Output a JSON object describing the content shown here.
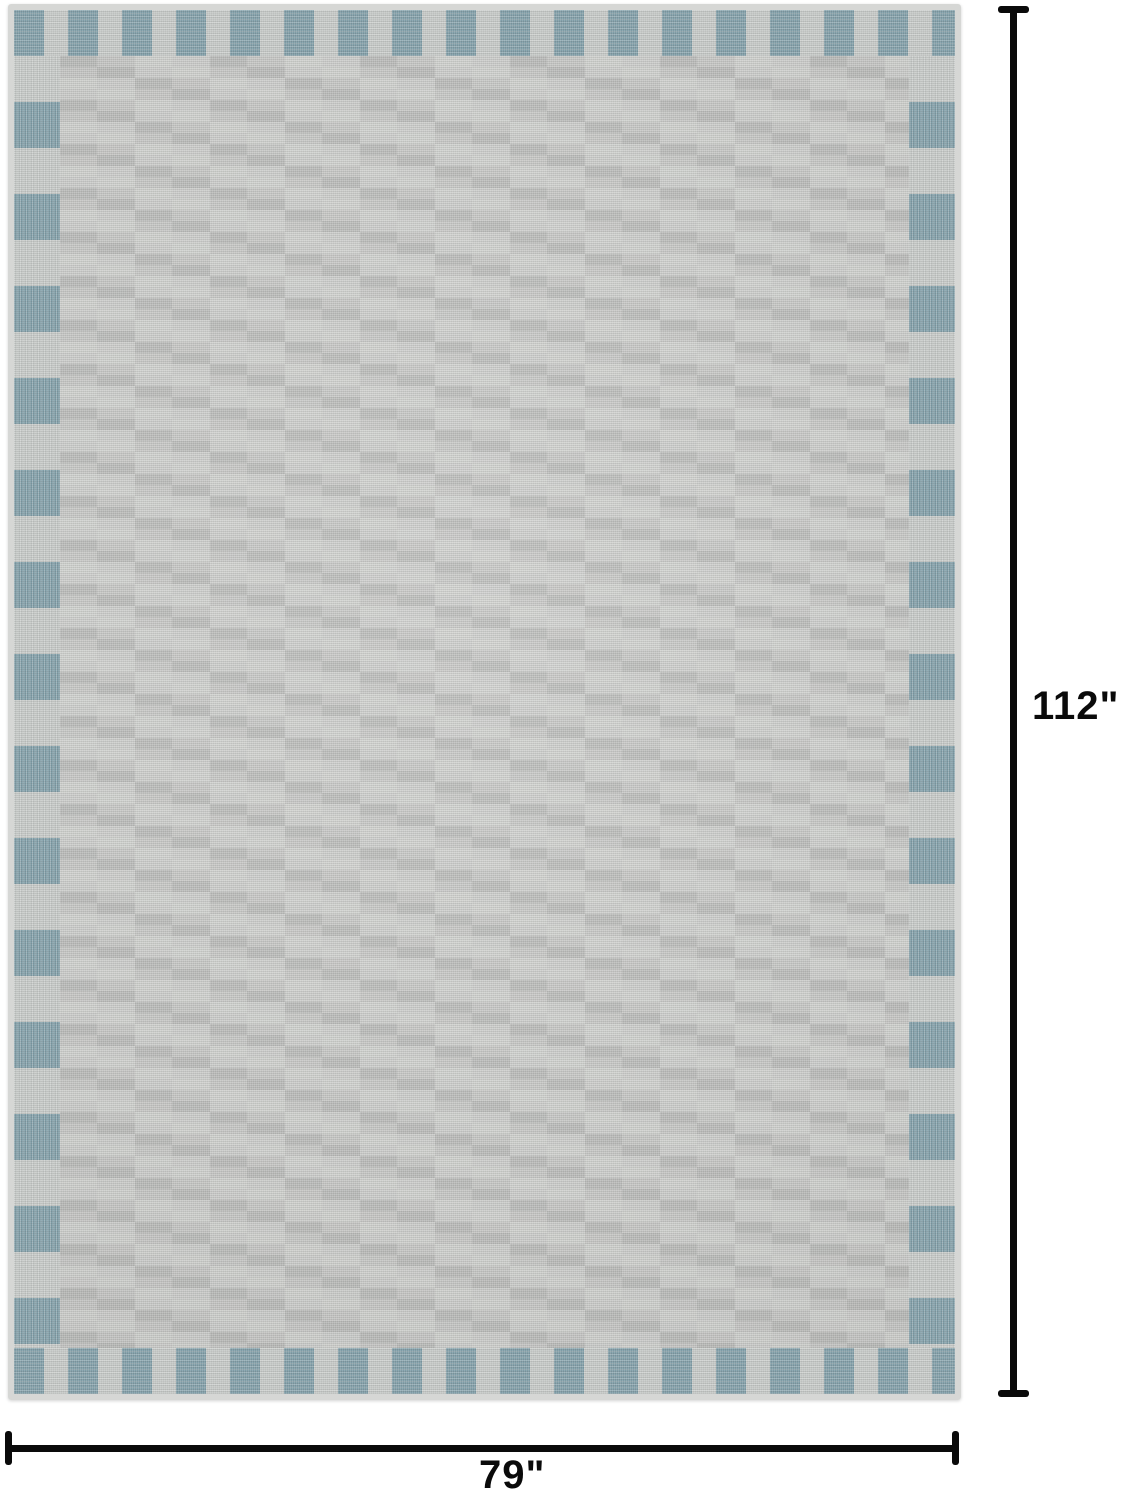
{
  "colors": {
    "page_bg": "#ffffff",
    "field_base": "#c6c7c5",
    "brick_light": "#cccdcb",
    "brick_dark": "#bbbcba",
    "border_teal": "#7e9ca6",
    "border_gray": "#c5c8c6",
    "rug_edge": "#d6d7d5",
    "dim_color": "#0a0a0a"
  },
  "product": {
    "description": "gray area rug with woven brick texture and teal checkerboard border"
  },
  "dimensions": {
    "height_label": "112\"",
    "width_label": "79\""
  }
}
